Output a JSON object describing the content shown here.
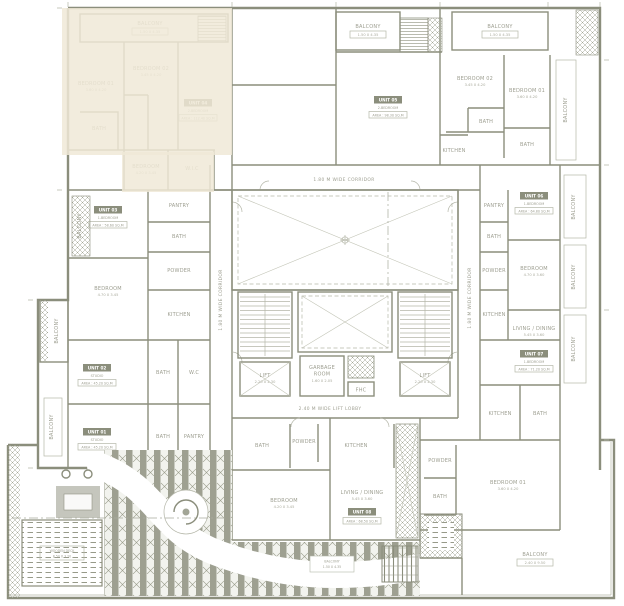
{
  "colors": {
    "wall": "#8b8e7c",
    "highlight": "#f0e9d7",
    "hatch": "#9a9d8c",
    "background": "#ffffff"
  },
  "plan": {
    "corridor_top": "1.80 M WIDE CORRIDOR",
    "corridor_left": "1.80 M WIDE CORRIDOR",
    "corridor_right": "1.80 M WIDE CORRIDOR",
    "lift_lobby": "2.40 M WIDE LIFT LOBBY"
  },
  "core": {
    "lift": "LIFT",
    "lift_dims": "2.20 X 2.30",
    "garbage_1": "GARBAGE",
    "garbage_2": "ROOM",
    "garbage_dims": "1.60 X 2.05",
    "fhc": "FHC"
  },
  "rooms": {
    "balcony": {
      "label": "BALCONY",
      "dims": "1.50 X 4.35"
    },
    "balcony_big": {
      "label": "BALCONY",
      "dims": "2.40 X 9.50"
    },
    "bed01": {
      "label": "BEDROOM 01",
      "dims": "3.60 X 4.20"
    },
    "bed02": {
      "label": "BEDROOM 02",
      "dims": "3.45 X 4.20"
    },
    "bed_l": {
      "label": "BEDROOM",
      "dims": "4.70 X 3.45"
    },
    "bed_r": {
      "label": "BEDROOM",
      "dims": "4.70 X 3.60"
    },
    "bed_c": {
      "label": "BEDROOM",
      "dims": "4.20 X 3.45"
    },
    "living": {
      "label": "LIVING / DINING",
      "dims": "5.45 X 3.60"
    },
    "bath": {
      "label": "BATH",
      "dims": "1.60 X 2.40"
    },
    "kitchen": {
      "label": "KITCHEN",
      "dims": "2.40 X 3.20"
    },
    "pantry": {
      "label": "PANTRY",
      "dims": "1.20 X 1.50"
    },
    "powder": {
      "label": "POWDER",
      "dims": "1.20 X 1.50"
    },
    "wic": {
      "label": "W.I.C",
      "dims": "1.80 X 1.50"
    },
    "wc": {
      "label": "W.C",
      "dims": "1.20 X 1.50"
    },
    "deck": {
      "label": "WOODEN DECK",
      "dims": "8.50 X 3.20"
    }
  },
  "units": [
    {
      "name": "UNIT 01",
      "type": "STUDIO",
      "area": "AREA : 45.20 SQ.M"
    },
    {
      "name": "UNIT 02",
      "type": "STUDIO",
      "area": "AREA : 45.20 SQ.M"
    },
    {
      "name": "UNIT 03",
      "type": "1-BEDROOM",
      "area": "AREA : 58.60 SQ.M"
    },
    {
      "name": "UNIT 04",
      "type": "2-BEDROOM",
      "area": "AREA : 112.40 SQ.M"
    },
    {
      "name": "UNIT 05",
      "type": "2-BEDROOM",
      "area": "AREA : 98.30 SQ.M"
    },
    {
      "name": "UNIT 06",
      "type": "1-BEDROOM",
      "area": "AREA : 64.80 SQ.M"
    },
    {
      "name": "UNIT 07",
      "type": "1-BEDROOM",
      "area": "AREA : 71.20 SQ.M"
    },
    {
      "name": "UNIT 08",
      "type": "1-BEDROOM",
      "area": "AREA : 68.50 SQ.M"
    }
  ]
}
